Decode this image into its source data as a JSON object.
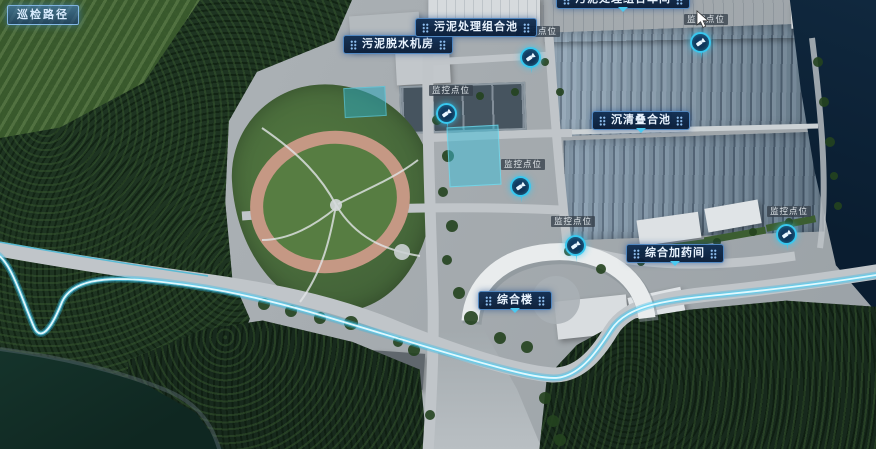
{
  "toolbar": {
    "patrol_path_button": "巡检路径"
  },
  "map": {
    "building_labels": [
      {
        "text": "污泥脱水机房"
      },
      {
        "text": "污泥处理组合池"
      },
      {
        "text": "污泥处理组合车间"
      },
      {
        "text": "沉清叠合池"
      },
      {
        "text": "综合加药间"
      },
      {
        "text": "综合楼"
      }
    ],
    "camera_points": [
      {
        "label": "监控点位"
      },
      {
        "label": "监控点位"
      },
      {
        "label": "监控点位"
      },
      {
        "label": "监控点位"
      },
      {
        "label": "监控点位"
      },
      {
        "label": "监控点位"
      }
    ]
  },
  "colors": {
    "label_background": "#0d2a4e",
    "label_border": "#4a85c2",
    "marker_ring": "#38c8f0",
    "patrol_route_glow": "#9feaff",
    "highlight_pool": "#2fb4c8",
    "button_border": "#9fd0ff"
  }
}
